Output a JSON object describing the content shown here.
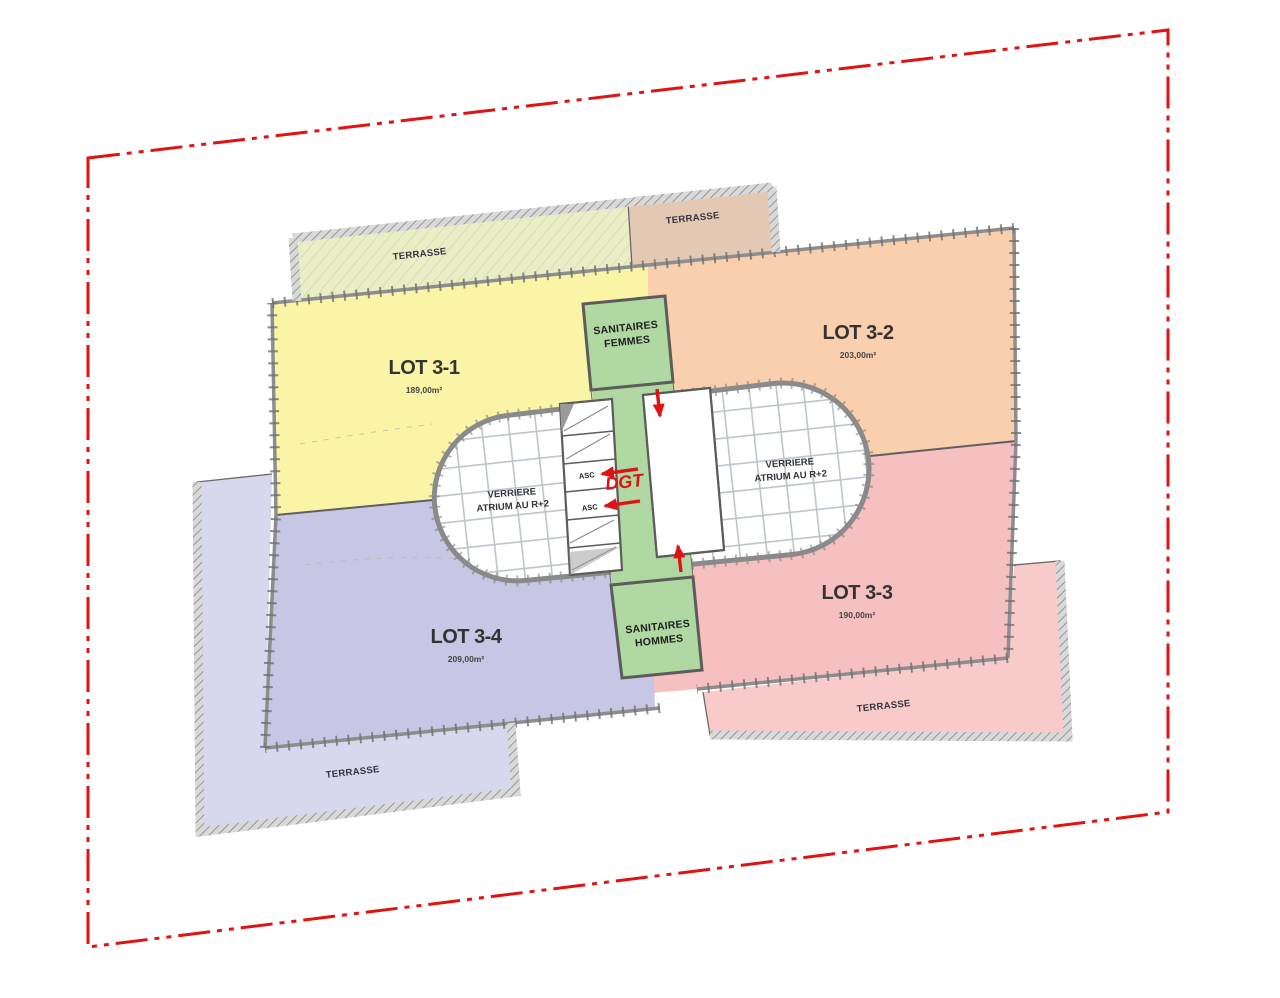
{
  "boundary": {
    "color": "#e01313"
  },
  "lots": [
    {
      "label": "LOT 3-1",
      "area": "189,00m²",
      "color": "#faf5a6"
    },
    {
      "label": "LOT 3-2",
      "area": "203,00m²",
      "color": "#f9cfae"
    },
    {
      "label": "LOT 3-3",
      "area": "190,00m²",
      "color": "#f7c0c0"
    },
    {
      "label": "LOT 3-4",
      "area": "209,00m²",
      "color": "#c7c7e5"
    }
  ],
  "terraces": [
    {
      "label": "TERRASSE",
      "color": "#eaeec6"
    },
    {
      "label": "TERRASSE",
      "color": "#e3c8b4"
    },
    {
      "label": "TERRASSE",
      "color": "#d7d7ed"
    },
    {
      "label": "TERRASSE",
      "color": "#f9caca"
    }
  ],
  "sanitaires": {
    "color": "#b0d8a2",
    "femmes": {
      "line1": "SANITAIRES",
      "line2": "FEMMES"
    },
    "hommes": {
      "line1": "SANITAIRES",
      "line2": "HOMMES"
    }
  },
  "atrium": {
    "line1": "VERRIERE",
    "line2": "ATRIUM AU R+2"
  },
  "elevator_label": "ASC",
  "circulation_label": "DGT"
}
